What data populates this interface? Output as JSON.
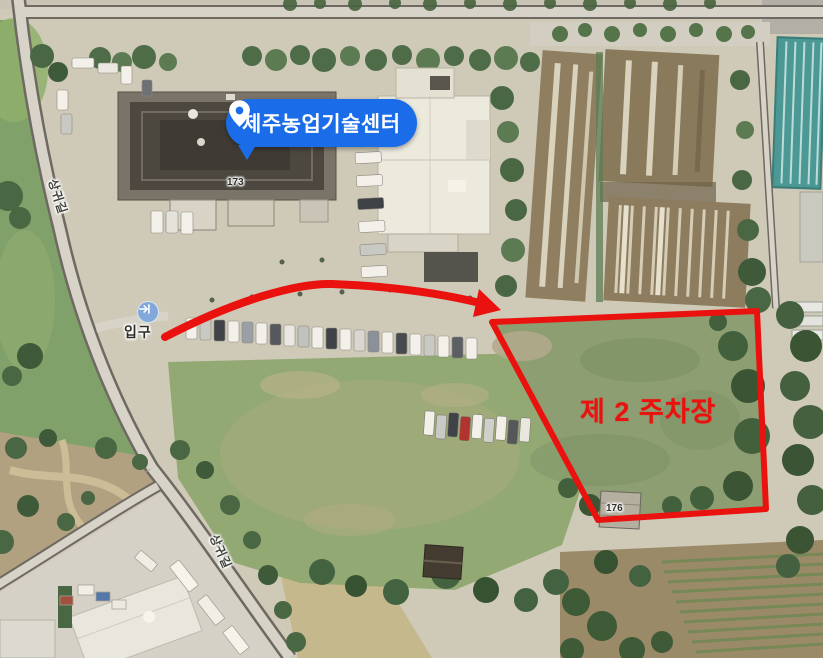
{
  "labels": {
    "place": "제주농업기술센터",
    "parking_area": "제 2 주차장",
    "entrance": "입구",
    "road_1": "상귀길",
    "road_2": "상귀길",
    "building_number_main": "173",
    "building_number_small": "176"
  },
  "icons": {
    "place_pin": "map-pin",
    "entrance_marker": "entrance-arrow-circle"
  },
  "colors": {
    "marker_blue": "#1a6ce8",
    "annotation_red": "#e9120e",
    "entrance_icon_blue": "#76a3de"
  }
}
